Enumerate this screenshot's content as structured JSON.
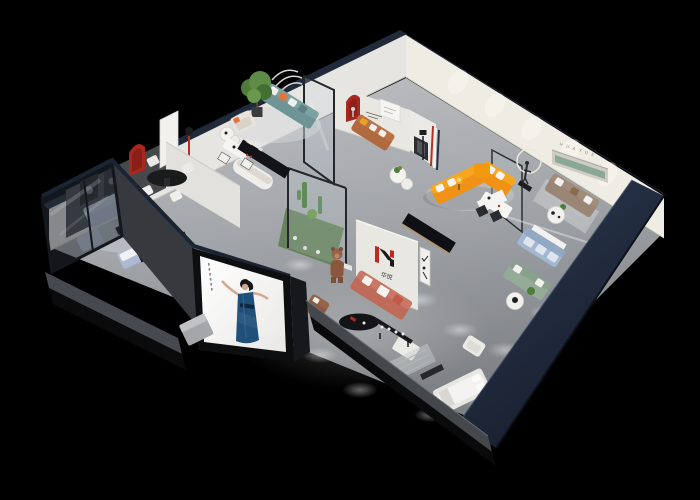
{
  "scene": {
    "type": "isometric-3d-showroom-render",
    "background": "#000000",
    "brand": {
      "logo_text": "华悦",
      "niche_letters": "H U A Y U E"
    },
    "palette": {
      "exterior_wall_navy": "#232c3c",
      "interior_wall_white": "#e9e7e2",
      "far_wall_cream": "#efece4",
      "floor_gray": "#a8abaf",
      "accent_red": "#a8271f",
      "sofa_orange": "#ef9215",
      "sofa_salmon": "#bf6b59",
      "sofa_teal": "#6f9496",
      "sofa_periwinkle": "#b9c3d8",
      "sofa_caramel": "#b06a3e",
      "sofa_taupe": "#9b8574",
      "sofa_sage": "#93ab97",
      "sofa_blue": "#a3b8d0",
      "niche_green": "#8aa895",
      "billboard_dress_blue": "#205079"
    }
  }
}
